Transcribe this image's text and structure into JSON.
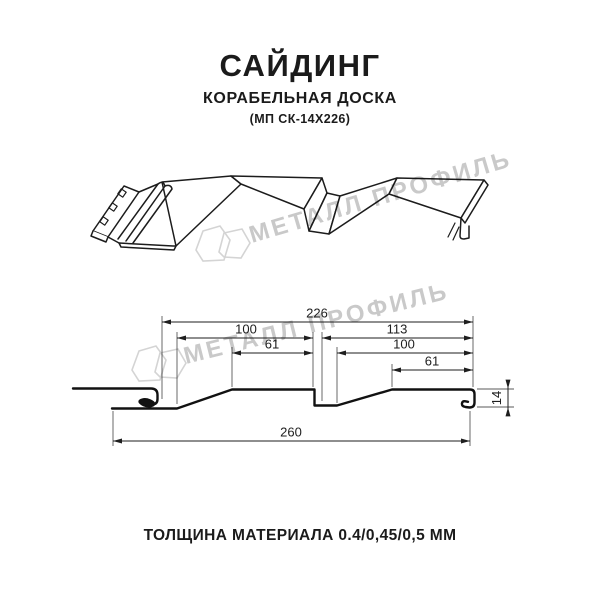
{
  "header": {
    "title": "САЙДИНГ",
    "subtitle": "КОРАБЕЛЬНАЯ ДОСКА",
    "model": "(МП СК-14Х226)"
  },
  "watermark": {
    "brand": "МЕТАЛЛ ПРОФИЛЬ"
  },
  "diagram": {
    "type": "siding-profile-technical-drawing",
    "dimensions_mm": {
      "overall_profile_width": "226",
      "left_module": "100",
      "right_module": "113",
      "left_flat": "61",
      "right_flat_module": "100",
      "right_flat": "61",
      "total_width": "260",
      "profile_height": "14"
    }
  },
  "footer": {
    "thickness": "ТОЛЩИНА МАТЕРИАЛА 0.4/0,45/0,5 ММ"
  },
  "colors": {
    "line": "#1c1c1c",
    "dimension": "#1e1e1e",
    "watermark": "#c9c9c9"
  }
}
